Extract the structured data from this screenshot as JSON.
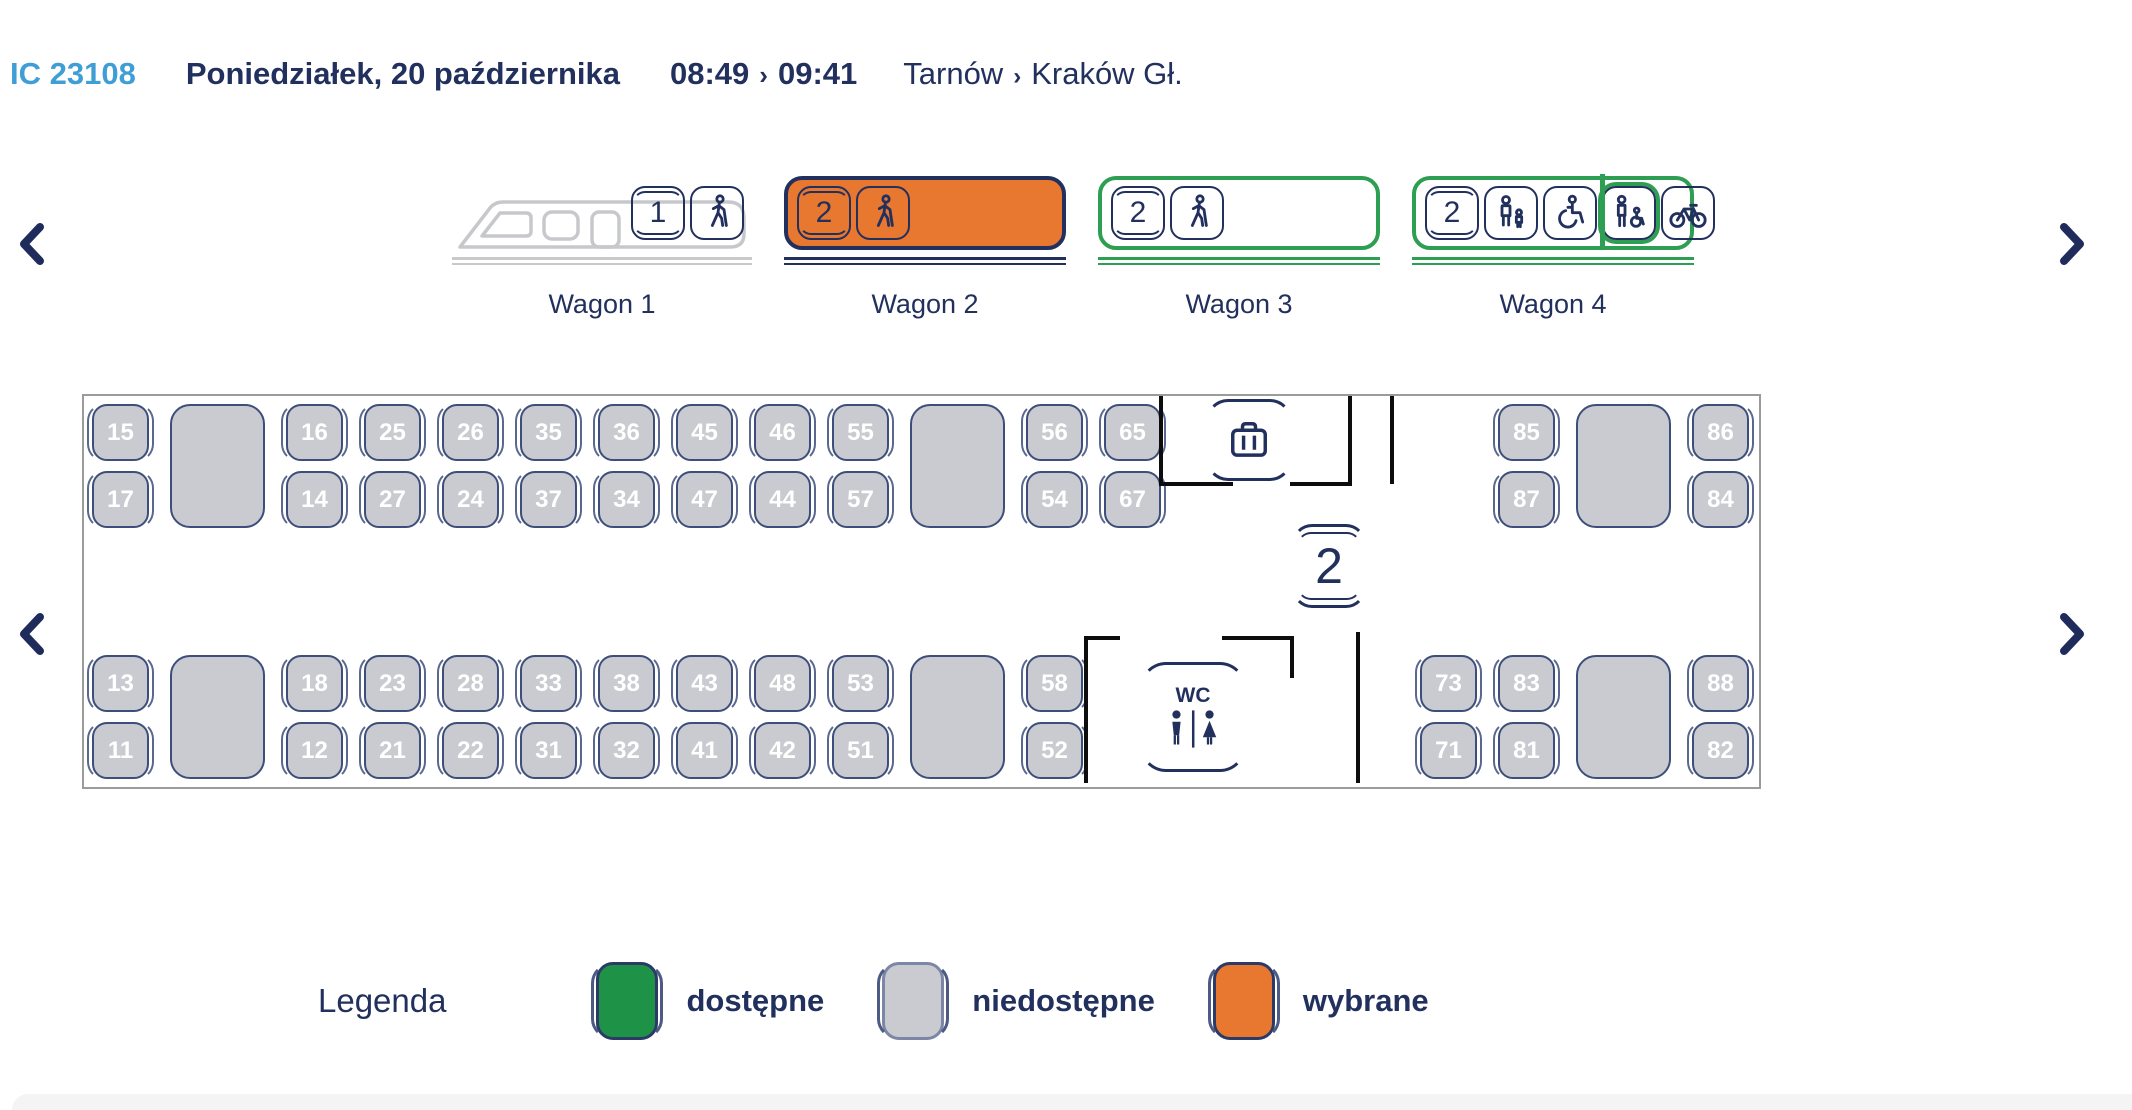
{
  "header": {
    "train_id": "IC 23108",
    "date": "Poniedziałek, 20 października",
    "depart_time": "08:49",
    "arrive_time": "09:41",
    "time_separator": "›",
    "origin": "Tarnów",
    "route_separator": "›",
    "destination": "Kraków Gł."
  },
  "nav": {
    "prev_icon": "chevron-left-icon",
    "next_icon": "chevron-right-icon"
  },
  "wagon_selector": {
    "wagons": [
      {
        "label": "Wagon 1",
        "type": "locomotive",
        "state": "unavailable",
        "icons": [
          {
            "name": "class-1",
            "text": "1"
          },
          {
            "name": "walker"
          }
        ]
      },
      {
        "label": "Wagon 2",
        "type": "car",
        "state": "selected",
        "icons": [
          {
            "name": "class-2",
            "text": "2"
          },
          {
            "name": "walker"
          }
        ]
      },
      {
        "label": "Wagon 3",
        "type": "car",
        "state": "available",
        "icons": [
          {
            "name": "class-2",
            "text": "2"
          },
          {
            "name": "walker"
          }
        ]
      },
      {
        "label": "Wagon 4",
        "type": "car",
        "state": "available",
        "divider_after": 2,
        "highlight_icon": 3,
        "icons": [
          {
            "name": "class-2",
            "text": "2"
          },
          {
            "name": "family"
          },
          {
            "name": "wheelchair"
          },
          {
            "name": "wheelchair-assist"
          },
          {
            "name": "bicycle"
          }
        ]
      }
    ]
  },
  "seat_map": {
    "class_marker": "2",
    "wc_label": "WC",
    "seat_state_all": "unavailable",
    "top_left_columns": [
      [
        "15",
        "17"
      ],
      "TALL",
      [
        "16",
        "14"
      ],
      [
        "25",
        "27"
      ],
      [
        "26",
        "24"
      ],
      [
        "35",
        "37"
      ],
      [
        "36",
        "34"
      ],
      [
        "45",
        "47"
      ],
      [
        "46",
        "44"
      ],
      [
        "55",
        "57"
      ],
      "TALL",
      [
        "56",
        "54"
      ],
      [
        "65",
        "67"
      ]
    ],
    "top_right_columns": [
      [
        "85",
        "87"
      ],
      "TALL",
      [
        "86",
        "84"
      ]
    ],
    "bottom_left_columns": [
      [
        "13",
        "11"
      ],
      "TALL",
      [
        "18",
        "12"
      ],
      [
        "23",
        "21"
      ],
      [
        "28",
        "22"
      ],
      [
        "33",
        "31"
      ],
      [
        "38",
        "32"
      ],
      [
        "43",
        "41"
      ],
      [
        "48",
        "42"
      ],
      [
        "53",
        "51"
      ],
      "TALL",
      [
        "58",
        "52"
      ]
    ],
    "bottom_right_columns": [
      [
        "73",
        "71"
      ],
      [
        "83",
        "81"
      ],
      "TALL",
      [
        "88",
        "82"
      ]
    ]
  },
  "legend": {
    "title": "Legenda",
    "items": [
      {
        "label": "dostępne",
        "state": "available",
        "color": "#1e9348"
      },
      {
        "label": "niedostępne",
        "state": "unavailable",
        "color": "#c9cbd0"
      },
      {
        "label": "wybrane",
        "state": "selected",
        "color": "#e8772f"
      }
    ]
  },
  "colors": {
    "navy": "#22305e",
    "accent_blue": "#3f9ed6",
    "orange": "#e8772f",
    "green": "#2e9e52",
    "seat_grey": "#c9cbd0",
    "seat_border": "#3e4e7a"
  }
}
